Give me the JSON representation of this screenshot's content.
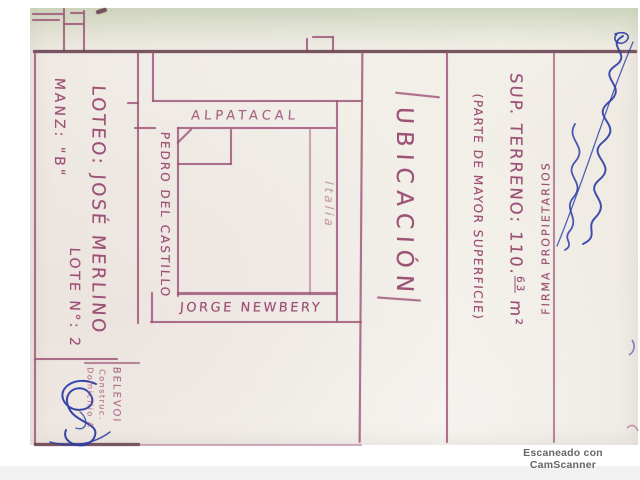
{
  "colors": {
    "ink_purple": "#9c5176",
    "ink_purple_dark": "#6b4652",
    "ink_blue": "#2b3da6",
    "paper": "#f2efea",
    "green_tint": "#dde5d2",
    "watermark_gray": "#666666"
  },
  "panel": {
    "manz": "MANZ: \"B\"",
    "loteo": "LOTEO: JOSÉ MERLINO",
    "lote": "LOTE N°: 2"
  },
  "map": {
    "street_top": "ALPATACAL",
    "street_left": "PEDRO DEL CASTILLO",
    "street_bottom": "JORGE NEWBERY",
    "street_right": "Italia"
  },
  "title": "UBICACIÓN",
  "details": {
    "sup_label": "SUP. TERRENO: 110.",
    "sup_frac": "63",
    "sup_unit": " m²",
    "parte": "(PARTE DE MAYOR SUPERFICIE)",
    "firma": "FIRMA PROPIETARIOS"
  },
  "stamp": {
    "line1": "BELEVOI",
    "line2": "Construc.",
    "line3": "Domicilio A"
  },
  "watermark": "Escaneado con CamScanner"
}
